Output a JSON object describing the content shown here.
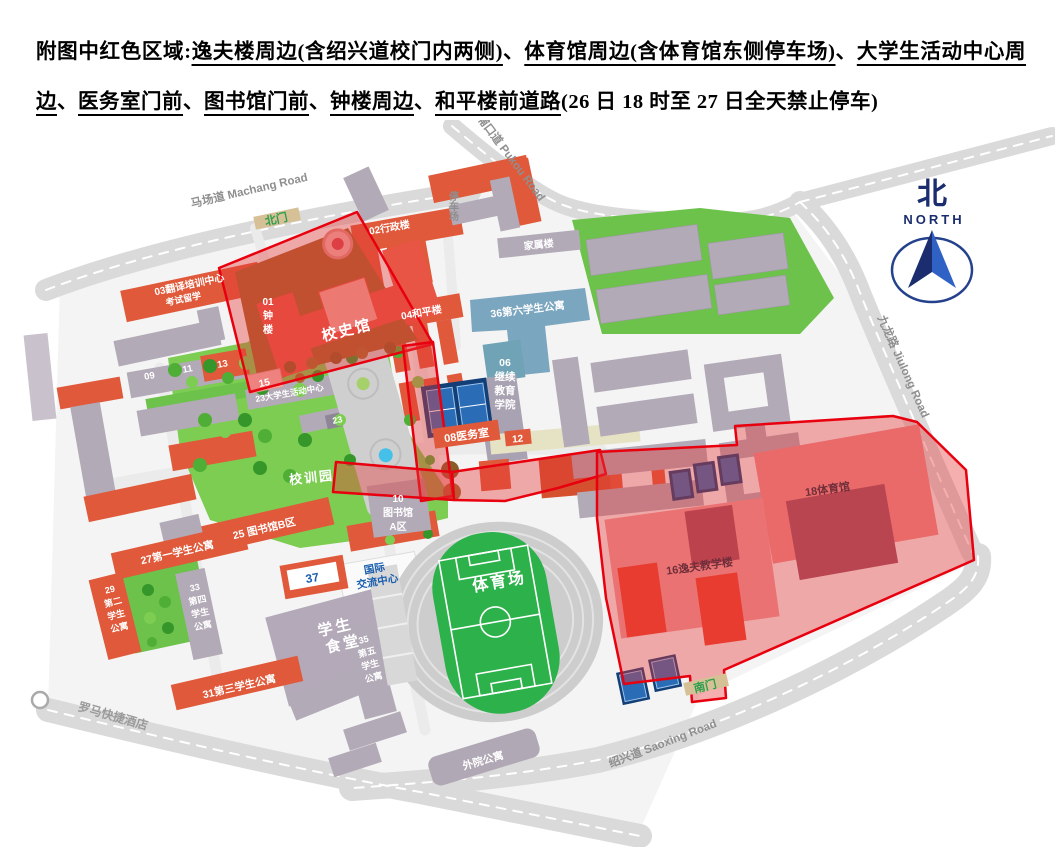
{
  "header": {
    "segments": [
      {
        "text": "附图中红色区域:",
        "underline": false
      },
      {
        "text": "逸夫楼周边(含绍兴道校门内两侧)",
        "underline": true
      },
      {
        "text": "、",
        "underline": false
      },
      {
        "text": "体育馆周边(含体育馆东侧停车场)",
        "underline": true
      },
      {
        "text": "、",
        "underline": false
      },
      {
        "text": "大学生活动中心周边",
        "underline": true
      },
      {
        "text": "、",
        "underline": false
      },
      {
        "text": "医务室门前",
        "underline": true
      },
      {
        "text": "、",
        "underline": false
      },
      {
        "text": "图书馆门前",
        "underline": true
      },
      {
        "text": "、",
        "underline": false
      },
      {
        "text": "钟楼周边",
        "underline": true
      },
      {
        "text": "、",
        "underline": false
      },
      {
        "text": "和平楼前道路",
        "underline": true
      },
      {
        "text": "(26 日 18 时至 27 日全天禁止停车)",
        "underline": false
      }
    ]
  },
  "map": {
    "roads": {
      "machang": "马场道 Machang Road",
      "pukou": "浦口道 Pukou Road",
      "jiulong": "九龙路 Jiulong Road",
      "saoxing": "绍兴道 Saoxing Road"
    },
    "gates": {
      "north": "北门",
      "south": "南门"
    },
    "compass": {
      "cn": "北",
      "en": "NORTH"
    },
    "areas": {
      "parking": "停车场",
      "garden": "校训园",
      "stadium": "体育场"
    },
    "buildings": {
      "b01": [
        "01",
        "钟",
        "楼"
      ],
      "xiaoshiguan": "校史馆",
      "b02": "02行政楼",
      "b03a": "03翻译培训中心",
      "b03b": "考试留学",
      "b04": "04和平楼",
      "b06": [
        "06",
        "继续",
        "教育",
        "学院"
      ],
      "b08": "08医务室",
      "b09": "09",
      "b11": "11",
      "b12": "12",
      "b13": "13",
      "b15": "15",
      "b23a": "23大学生活动中心",
      "b23b": "23",
      "b10": [
        "10",
        "图书馆",
        "A区"
      ],
      "b25": "25 图书馆B区",
      "b27": "27第一学生公寓",
      "b29": [
        "29",
        "第二",
        "学生",
        "公寓"
      ],
      "b31": "31第三学生公寓",
      "b33": [
        "33",
        "第四",
        "学生",
        "公寓"
      ],
      "b35": [
        "35",
        "第五",
        "学生",
        "公寓"
      ],
      "b36": "36第六学生公寓",
      "b37": "37",
      "intl": [
        "国际",
        "交流中心"
      ],
      "canteen": [
        "学生",
        "食堂"
      ],
      "jiashu": "家属楼",
      "b16": "16逸夫教学楼",
      "b18": "18体育馆",
      "waiyuan": "外院公寓",
      "hotel": "罗马快捷酒店"
    },
    "colors": {
      "orange": "#e0593a",
      "gray_building": "#b3aab8",
      "green": "#6cc24b",
      "lawn": "#7ccd52",
      "red_zone_stroke": "#e8000f",
      "red_zone_fill": "rgba(231,56,56,0.40)",
      "court_navy": "#123f77",
      "court_blue": "#2a6cb5",
      "blue_building": "#7ba6bf",
      "teal": "#6fa3b5",
      "navy": "#1b2d6e",
      "blue": "#2f62c4",
      "road": "#dadada",
      "brown_yard": "#a8622c",
      "pink_zone_building": "#ed8a8a",
      "dark_maroon": "#9b4f63",
      "gate_sign": "#d6c196"
    }
  }
}
